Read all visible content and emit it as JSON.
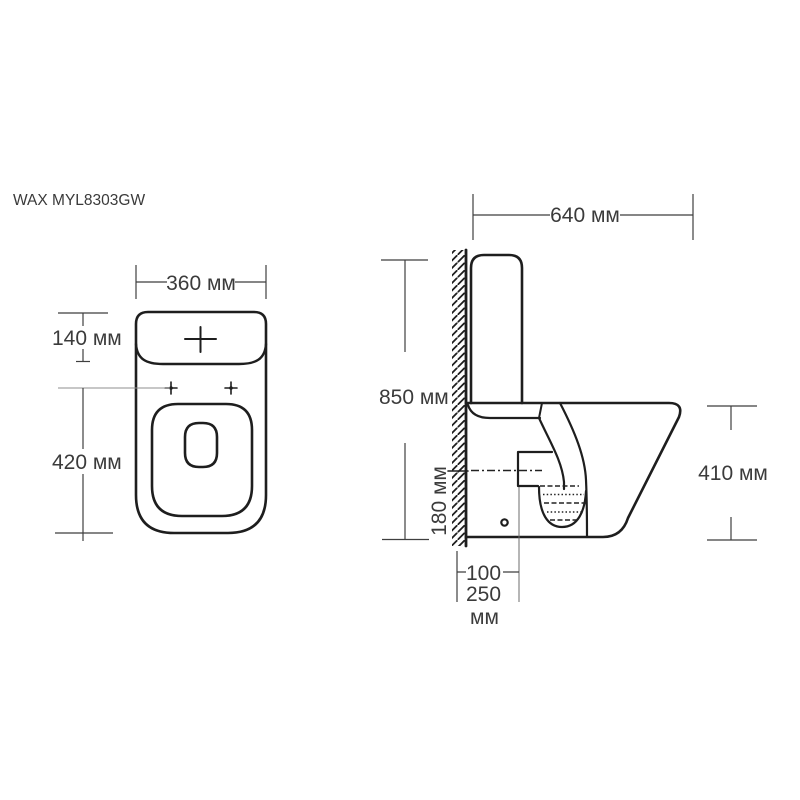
{
  "title": "WAX MYL8303GW",
  "top_view": {
    "width_label": "360 мм",
    "tank_depth_label": "140 мм",
    "length_label": "420 мм"
  },
  "side_view": {
    "depth_label": "640 мм",
    "height_label": "850 мм",
    "outlet_height_label": "180 мм",
    "bowl_height_label": "410 мм",
    "rough_in_value_1": "100",
    "rough_in_value_2": "250",
    "rough_in_unit": "мм"
  },
  "colors": {
    "background": "#ffffff",
    "outline": "#1e1e1e",
    "dimension": "#3f3f3f"
  }
}
